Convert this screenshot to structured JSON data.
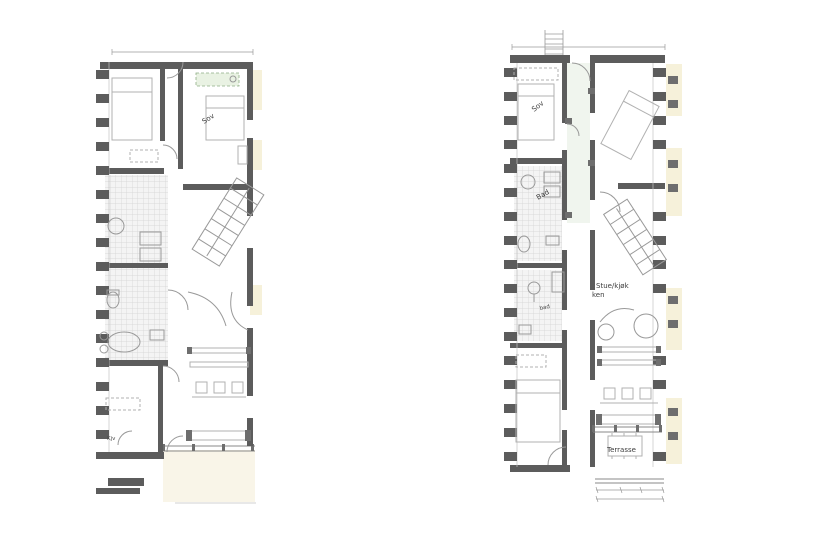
{
  "document": {
    "type": "architectural-floor-plans",
    "background": "#ffffff"
  },
  "colors": {
    "wall": "#5c5c5c",
    "furniture_line": "#b1b1b1",
    "tile_line": "#d2d2d2",
    "tile_bg": "#f4f4f4",
    "neighbor_cream": "#f6f1da",
    "terrace_cream": "#f9f5e8",
    "highlight_green_fill": "#e9f2e3",
    "highlight_green_stroke": "#8fae85",
    "corridor_tint": "#f0f5ee",
    "label_text": "#3c3c3c"
  },
  "plan_left": {
    "name": "floor-plan-left",
    "rooms": {
      "bedroom_label": "Sov",
      "small_room_label": "Kjv"
    }
  },
  "plan_right": {
    "name": "floor-plan-right",
    "rooms": {
      "bedroom_label": "Sov",
      "bath_label": "Bad",
      "bath_small_label": "bad",
      "living_line1": "Stue/kjøk",
      "living_line2": "ken",
      "terrace_label": "Terrasse"
    }
  }
}
